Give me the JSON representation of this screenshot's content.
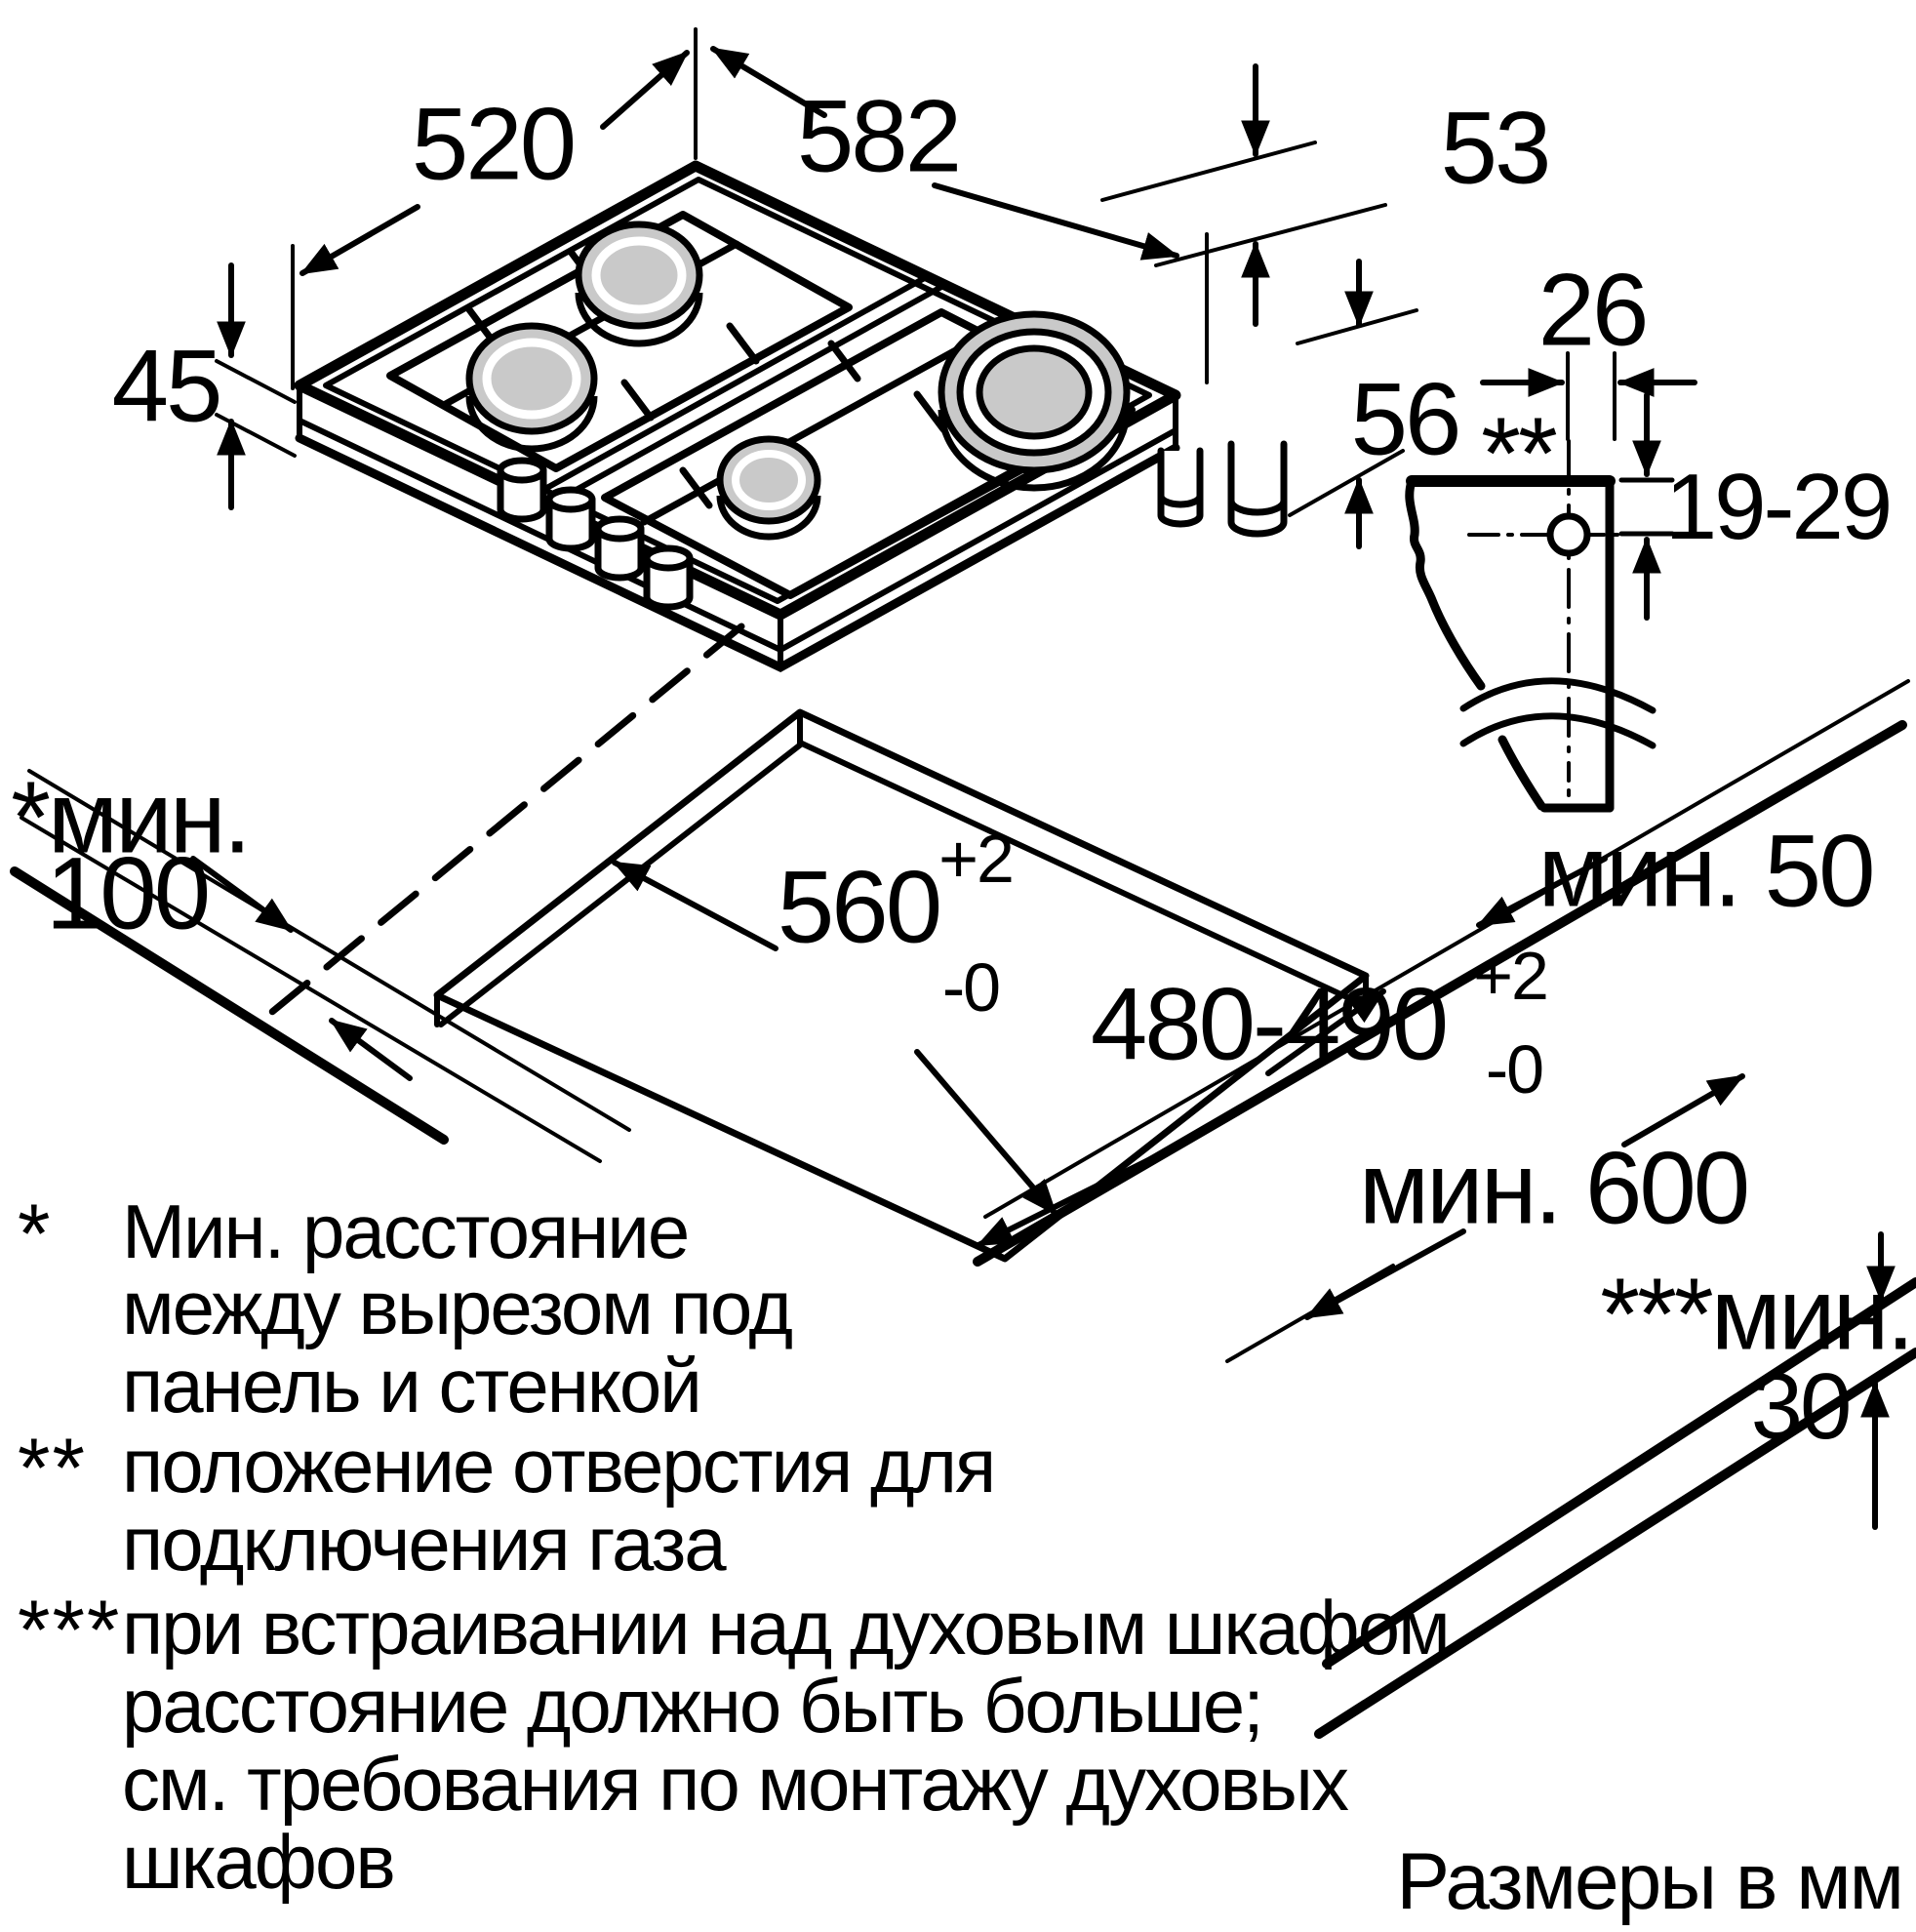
{
  "dimensions": {
    "hob_depth": "520",
    "hob_width": "582",
    "edge_gap": "53",
    "hob_height_above": "45",
    "gas_pipe_offset": "26",
    "hob_height_below": "56",
    "gas_hole_position": "19-29",
    "gas_hole_marker": "**",
    "cutout_width": "560",
    "cutout_width_tol_plus": "+2",
    "cutout_width_tol_minus": "-0",
    "cutout_depth": "480-490",
    "cutout_depth_tol_plus": "+2",
    "cutout_depth_tol_minus": "-0",
    "min_front_distance": "мин. 50",
    "min_wall_line1": "*мин.",
    "min_wall_line2": "100",
    "min_worktop_depth": "мин. 600",
    "min_oven_line1": "***мин.",
    "min_oven_line2": "30"
  },
  "footnotes": {
    "star_marker": "*",
    "star_line1": "Мин. расстояние",
    "star_line2": "между вырезом под",
    "star_line3": "панель и стенкой",
    "dstar_marker": "**",
    "dstar_line1": "положение отверстия для",
    "dstar_line2": "подключения газа",
    "tstar_marker": "***",
    "tstar_line1": "при встраивании над духовым шкафом",
    "tstar_line2": "расстояние должно быть больше;",
    "tstar_line3": "см. требования по монтажу духовых",
    "tstar_line4": "шкафов",
    "units": "Размеры в мм"
  },
  "colors": {
    "line": "#000000",
    "burner_fill": "#c9c9c9",
    "background": "#ffffff"
  }
}
